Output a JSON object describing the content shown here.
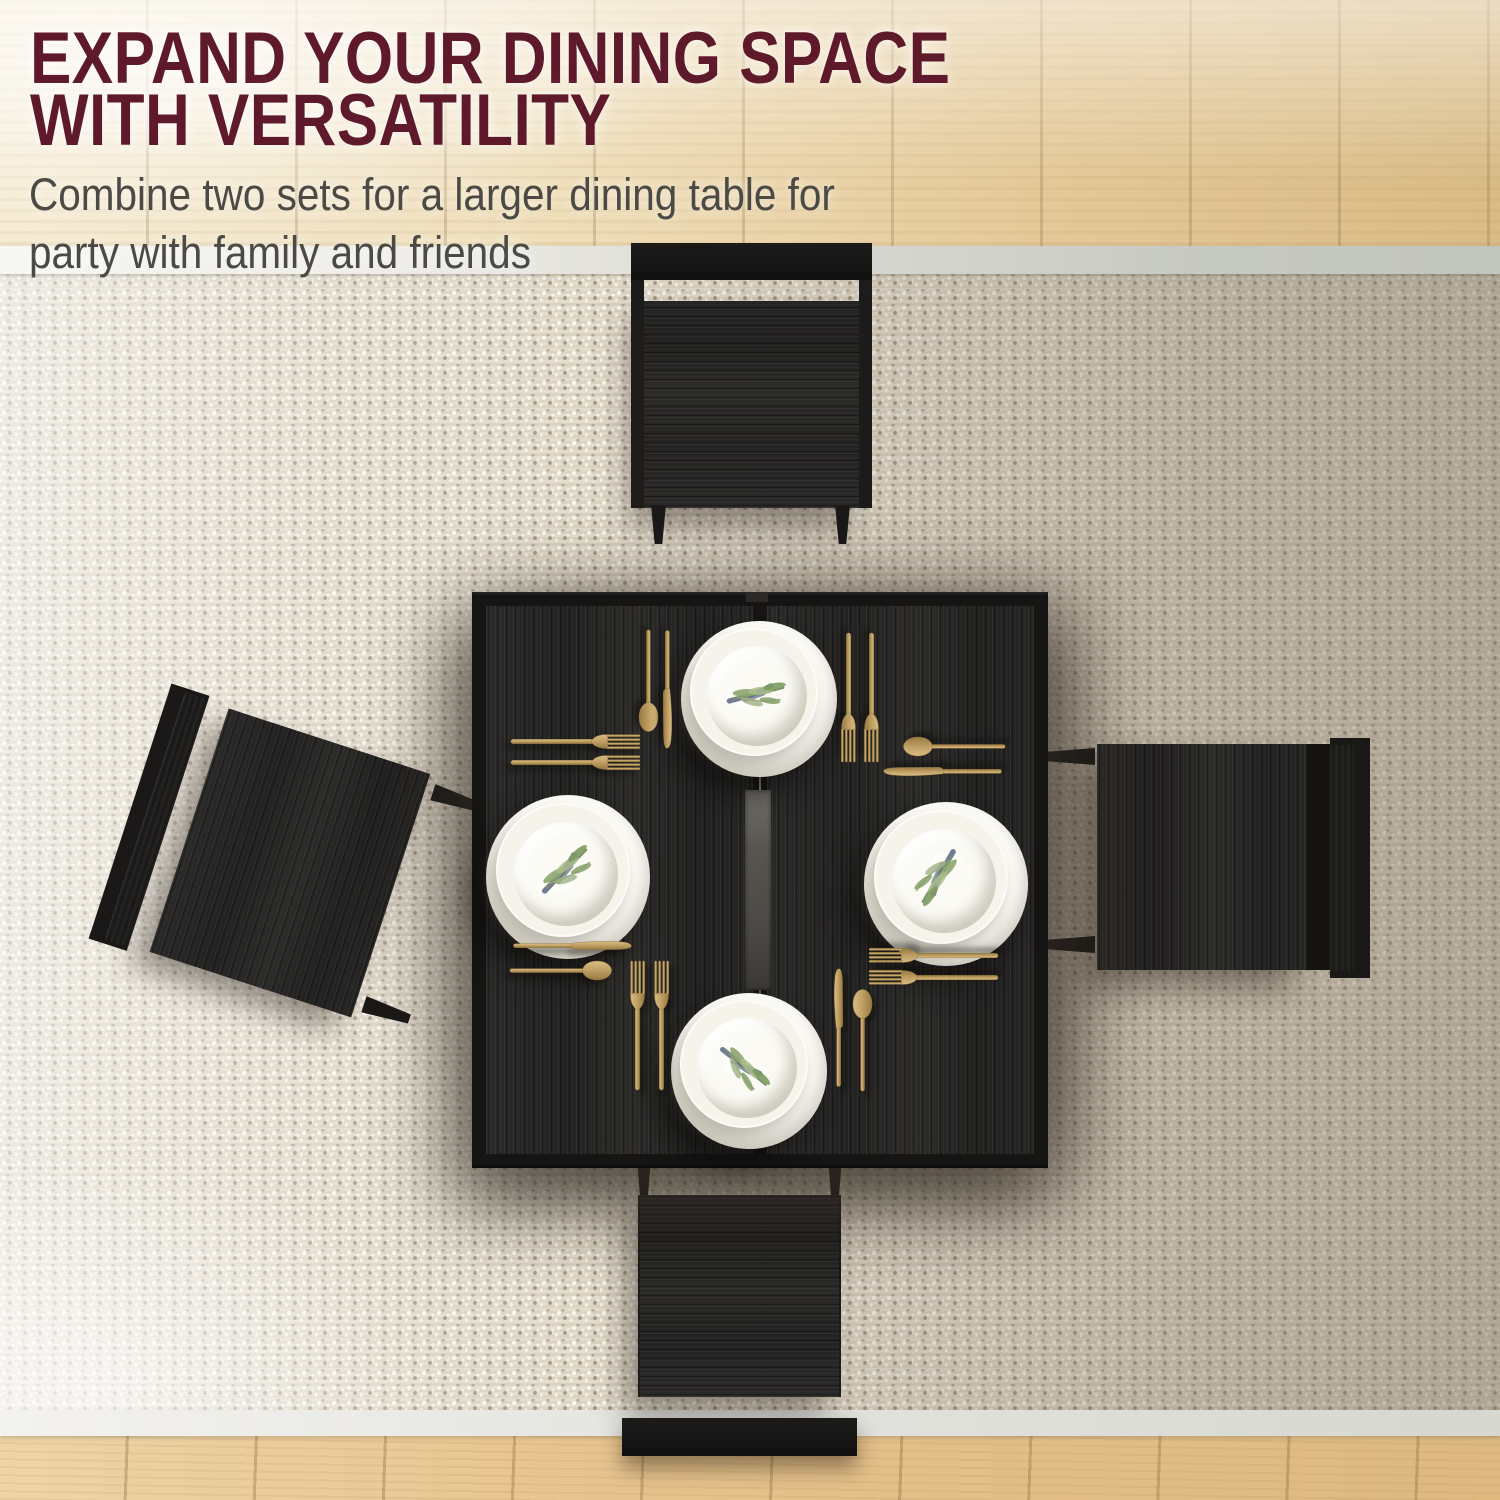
{
  "header": {
    "title_line1": "EXPAND YOUR DINING SPACE",
    "title_line2": "WITH VERSATILITY",
    "subtitle_line1": "Combine two sets for a larger dining table for",
    "subtitle_line2": "party with family and friends"
  },
  "colors": {
    "headline": "#5e1a2b",
    "subtitle": "#4b4a45",
    "gold": "#c2a266",
    "table_black": "#1e1d1c",
    "rug_light": "#efe9dd",
    "rug_dark": "#b3a492",
    "rug_border_band": "#c7cac2",
    "wood_floor_top": "#eedcb6",
    "wood_floor_bottom": "#e3c18c"
  },
  "scene": {
    "icons": [
      "fork-icon",
      "knife-icon",
      "spoon-icon",
      "plate-icon",
      "olive-branch-icon"
    ]
  }
}
